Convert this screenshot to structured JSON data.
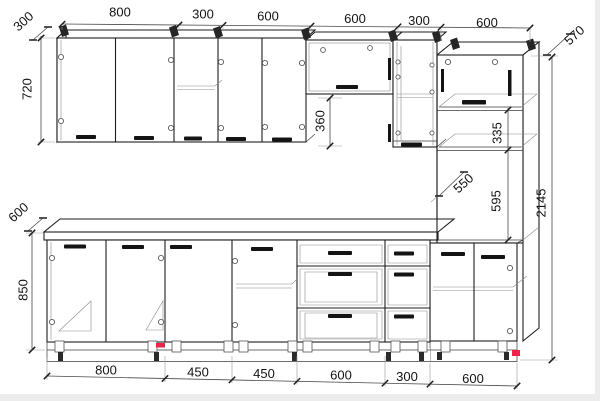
{
  "drawing": {
    "type": "kitchen-cabinet-set-elevation",
    "background": "#ffffff",
    "line_color": "#1e1e1e",
    "marker_color": "#ef2347",
    "dims": {
      "top": [
        "800",
        "300",
        "600",
        "600",
        "300",
        "600"
      ],
      "bottom": [
        "800",
        "450",
        "450",
        "600",
        "300",
        "600"
      ],
      "wall_depth": "300",
      "wall_height": "720",
      "under_wall_gap": "360",
      "base_depth": "600",
      "base_height": "850",
      "tall_top_depth": "570",
      "tall_shelf_section": "335",
      "tall_inner_depth": "550",
      "tall_open_section": "595",
      "total_height": "2145"
    }
  }
}
